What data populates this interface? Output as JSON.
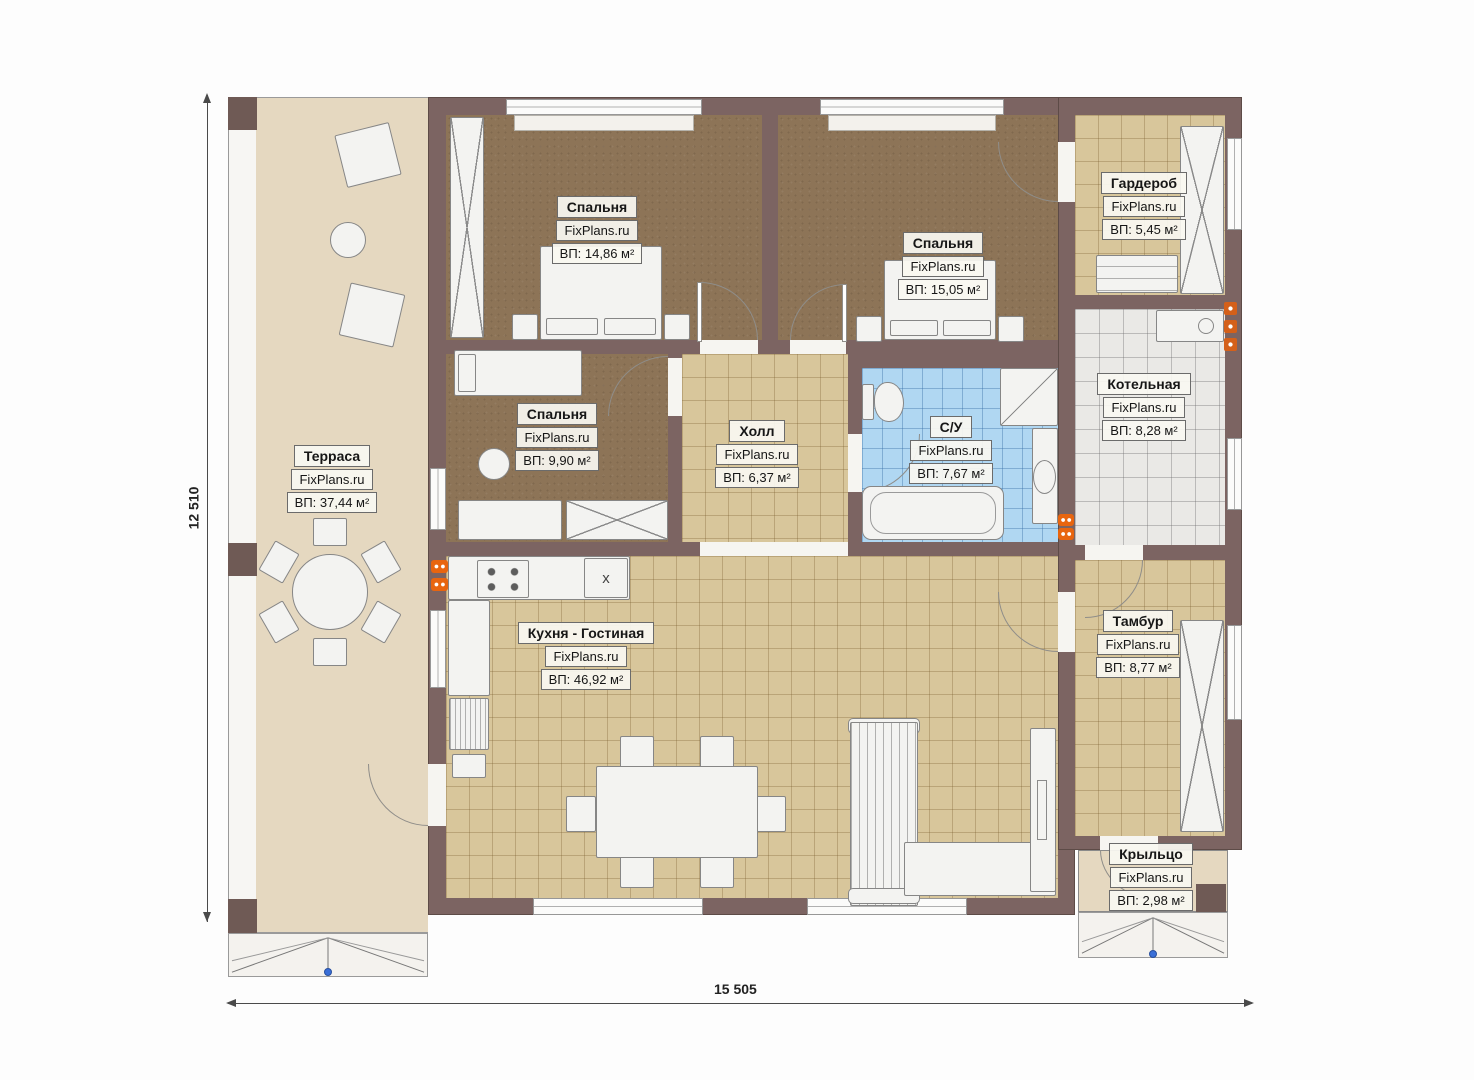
{
  "plan": {
    "brand": "FixPlans.ru",
    "dimensions": {
      "height_label": "12 510",
      "width_label": "15 505"
    },
    "rooms": [
      {
        "name": "Терраса",
        "brand": "FixPlans.ru",
        "area": "ВП: 37,44 м²"
      },
      {
        "name": "Спальня",
        "brand": "FixPlans.ru",
        "area": "ВП: 14,86 м²"
      },
      {
        "name": "Спальня",
        "brand": "FixPlans.ru",
        "area": "ВП: 15,05 м²"
      },
      {
        "name": "Гардероб",
        "brand": "FixPlans.ru",
        "area": "ВП: 5,45 м²"
      },
      {
        "name": "Спальня",
        "brand": "FixPlans.ru",
        "area": "ВП: 9,90 м²"
      },
      {
        "name": "Холл",
        "brand": "FixPlans.ru",
        "area": "ВП: 6,37 м²"
      },
      {
        "name": "С/У",
        "brand": "FixPlans.ru",
        "area": "ВП: 7,67 м²"
      },
      {
        "name": "Котельная",
        "brand": "FixPlans.ru",
        "area": "ВП: 8,28 м²"
      },
      {
        "name": "Кухня - Гостиная",
        "brand": "FixPlans.ru",
        "area": "ВП: 46,92 м²"
      },
      {
        "name": "Тамбур",
        "brand": "FixPlans.ru",
        "area": "ВП: 8,77 м²"
      },
      {
        "name": "Крыльцо",
        "brand": "FixPlans.ru",
        "area": "ВП: 2,98 м²"
      }
    ],
    "symbols": {
      "kitchen_sink": "х"
    },
    "colors": {
      "wall": "#7c6462",
      "wood_floor": "#8d7457",
      "tile_tan": "#d8c69b",
      "tile_blue": "#b0d7f2",
      "tile_gray": "#eae9e6",
      "terrace_floor": "#e5d8c0",
      "radiator": "#e8650f",
      "entrance_marker": "#3a6fd8"
    }
  }
}
